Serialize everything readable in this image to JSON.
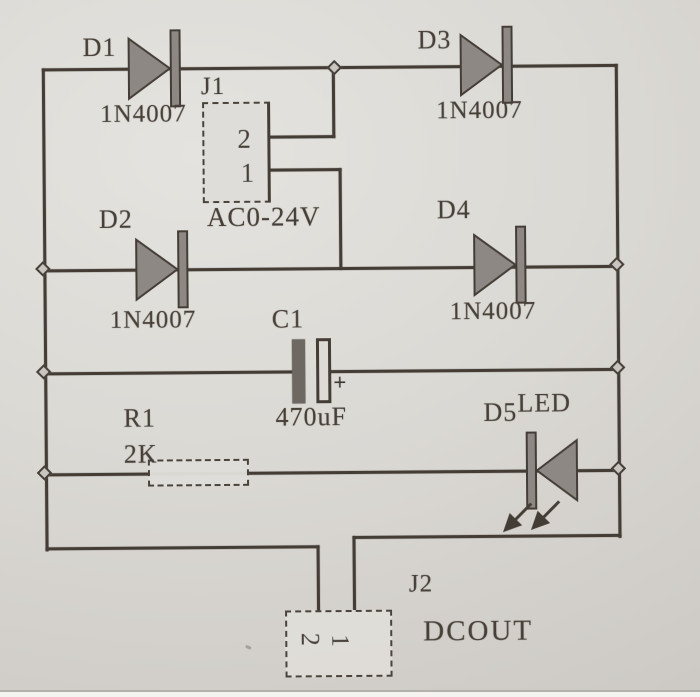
{
  "schematic": {
    "d1": {
      "ref": "D1",
      "part": "1N4007"
    },
    "d2": {
      "ref": "D2",
      "part": "1N4007"
    },
    "d3": {
      "ref": "D3",
      "part": "1N4007"
    },
    "d4": {
      "ref": "D4",
      "part": "1N4007"
    },
    "j1": {
      "ref": "J1",
      "pin2": "2",
      "pin1": "1",
      "note": "AC0-24V"
    },
    "c1": {
      "ref": "C1",
      "value": "470uF",
      "plus": "+"
    },
    "r1": {
      "ref": "R1",
      "value": "2K"
    },
    "d5": {
      "ref": "D5",
      "type": "LED"
    },
    "j2": {
      "ref": "J2",
      "pin2": "2",
      "pin1": "1",
      "note": "DCOUT"
    },
    "colors": {
      "paper": "#dbd9d4",
      "ink": "#443d36",
      "diode_fill": "#8d8883",
      "text": "#474038"
    }
  }
}
